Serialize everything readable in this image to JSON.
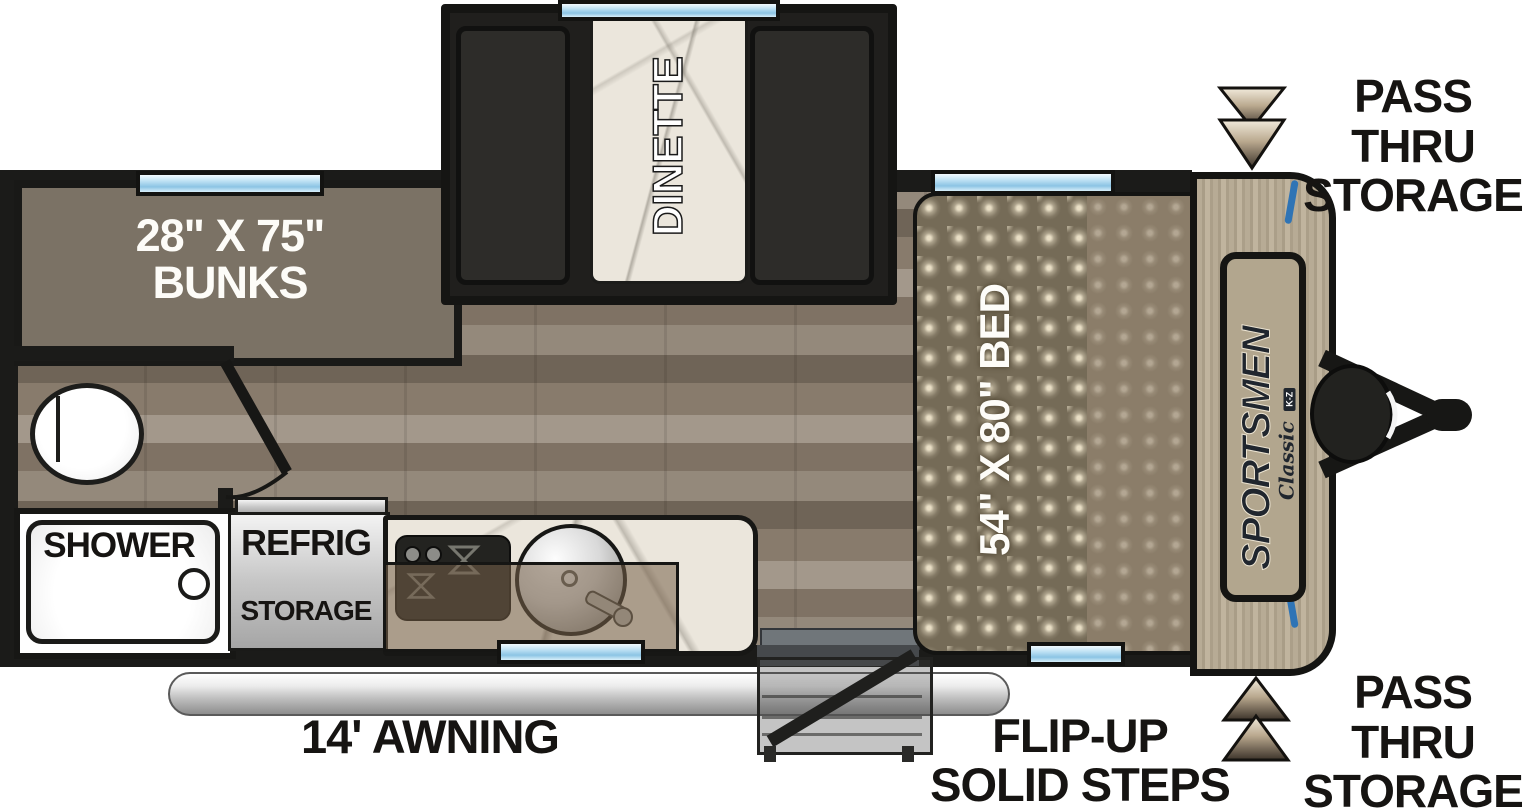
{
  "title": "Sportsmen Classic travel trailer floor plan",
  "labels": {
    "bunks_line1": "28\" X 75\"",
    "bunks_line2": "BUNKS",
    "dinette": "DINETTE",
    "bed": "54\" X 80\" BED",
    "shower": "SHOWER",
    "refrig": "REFRIG",
    "refrig_storage": "STORAGE",
    "awning": "14' AWNING",
    "steps_line1": "FLIP-UP",
    "steps_line2": "SOLID STEPS",
    "pass_thru_top_line1": "PASS THRU",
    "pass_thru_top_line2": "STORAGE",
    "pass_thru_bottom_line1": "PASS THRU",
    "pass_thru_bottom_line2": "STORAGE"
  },
  "brand": {
    "name": "SPORTSMEN",
    "series": "Classic",
    "maker": "K-Z"
  },
  "colors": {
    "wall": "#1b1b19",
    "window_blue": "#8cc4e4",
    "accent_blue": "#2f74b5",
    "bunks_fill": "#7b7265",
    "floor_wood": "#8a7e70",
    "front_cap_tan": "#b2a68e",
    "label_text": "#161412",
    "awning_silver": "#c9c9c9"
  }
}
